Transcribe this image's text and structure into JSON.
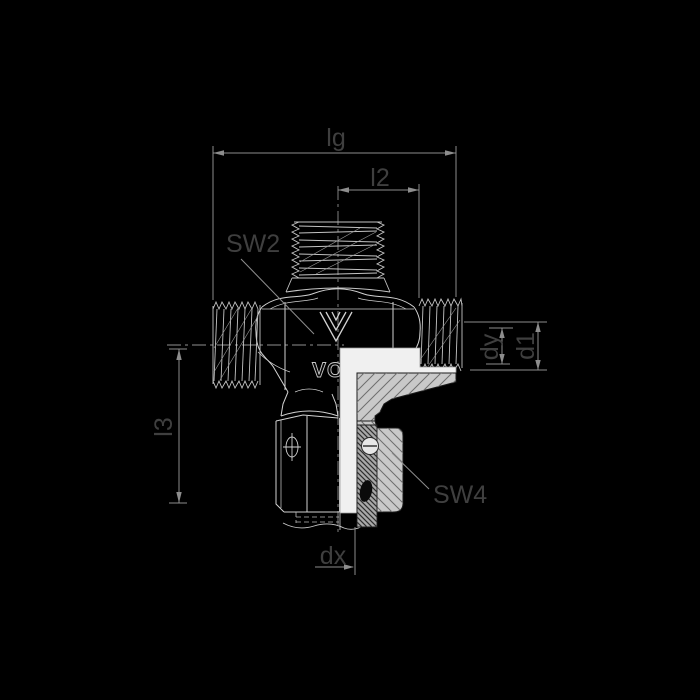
{
  "figure": {
    "background": "#000000",
    "description": "Sectioned technical drawing of a tee swivel tube fitting with three threaded ports",
    "colors": {
      "part_outline": "#d2d2d2",
      "thread_line": "#b8b8b8",
      "dimension_line": "#8d8d8d",
      "label_text": "#3f3f3f",
      "section_fill": "#c9c9c9",
      "section_face": "#f0f0f0",
      "seal": "#0b0b0b"
    },
    "labels": {
      "lg": "lg",
      "l2": "l2",
      "sw2": "SW2",
      "dy": "dy",
      "d1": "d1",
      "l3": "l3",
      "sw4": "SW4",
      "dx": "dx"
    },
    "part_marking": "VO"
  }
}
